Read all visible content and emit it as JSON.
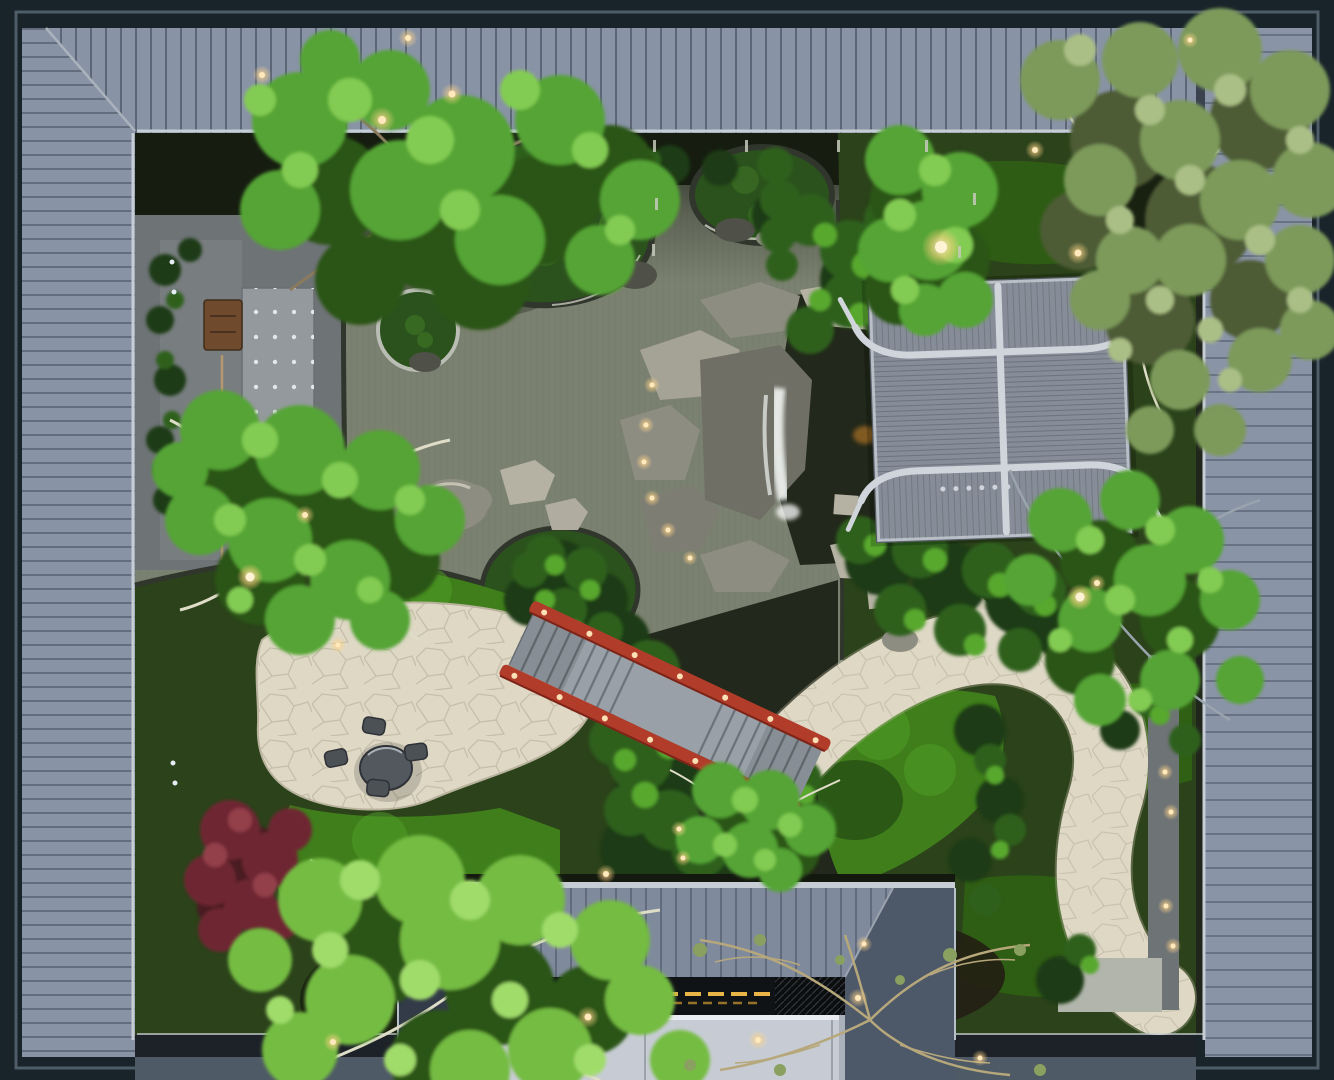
{
  "scene": {
    "subject": "Top-down aerial view of a Chinese courtyard garden at dusk",
    "setting": "Enclosed residential courtyard with pond, moss islands, rock waterfall, tiled pavilion roof, red arched bridge, flagstone paths and warm garden lights",
    "view": "directly overhead",
    "lighting": "dusk with warm landscape lights"
  },
  "colors": {
    "frame_dark": "#18232a",
    "frame_edge": "#4e5d68",
    "roof_plank": "#8893a6",
    "roof_plank_right": "#8a94a7",
    "roof_seam": "#39424e",
    "gutter_light": "#c6cdd4",
    "eave_shadow": "#20261c",
    "plant_strip": "#161d10",
    "water": "#7b8170",
    "pool_dark": "#22281b",
    "pond_rim": "#31362d",
    "pond_rim_light": "#c6c9ba",
    "island_moss": "#2b521d",
    "island_moss_light": "#47862a",
    "garden_base": "#2b421a",
    "stone_ground": "#6e7376",
    "lawn": "#3f7e1b",
    "lawn_light": "#52a028",
    "lawn_dark": "#2f6014",
    "shadow_green": "#1c3a10",
    "shrub_dark": "#1f3a12",
    "shrub_mid": "#2f611d",
    "shrub_light": "#58a82f",
    "tree_dark": "#2a5517",
    "tree_bright": "#55a434",
    "tree_light": "#83cc52",
    "tree_yellow": "#74bc42",
    "tree_yellow_light": "#a0dc6a",
    "tree_olive": "#7d9a5a",
    "tree_olive_light": "#aabf85",
    "olive_dark": "#4e5c36",
    "branch_light": "#dfddc8",
    "branch_gray": "#9aa4ae",
    "branch_tan": "#8a7a5e",
    "bare_branch": "#b7a87c",
    "bare_leaf": "#8aa060",
    "maple_red": "#6e2732",
    "maple_dark": "#4a1a22",
    "maple_light": "#94404c",
    "path_stone": "#ded8c5",
    "path_edge": "#b9b29d",
    "rock_gray": "#8e8d82",
    "rock_light": "#b5b2a4",
    "rock_dark": "#4f5047",
    "rock_wet": "#6f6f65",
    "terrace_gray": "#7e8386",
    "terrace_light": "#94999d",
    "bench_wood": "#6f4a2d",
    "table_stone": "#53585e",
    "stool_stone": "#4c5156",
    "pavilion_tile": "#868d98",
    "pavilion_ridge": "#d0d5dc",
    "bridge_red": "#b23c2a",
    "bridge_red_dark": "#7c2418",
    "bridge_deck": "#99a0a8",
    "building_roof": "#7f8a9c",
    "building_roof_dark": "#4d5868",
    "building_wing": "#3a4350",
    "building_glass": "#101316",
    "building_light": "#e8b546",
    "building_flat": "#c7ccd4",
    "light_core": "#ffe9bd",
    "light_white": "#e6eef4",
    "waterfall_white": "#eef2ef",
    "koi_orange": "#d08427",
    "flower_purple": "#8578c0",
    "mulch_dark": "#241f14",
    "warm_trim": "#c9a06a"
  }
}
